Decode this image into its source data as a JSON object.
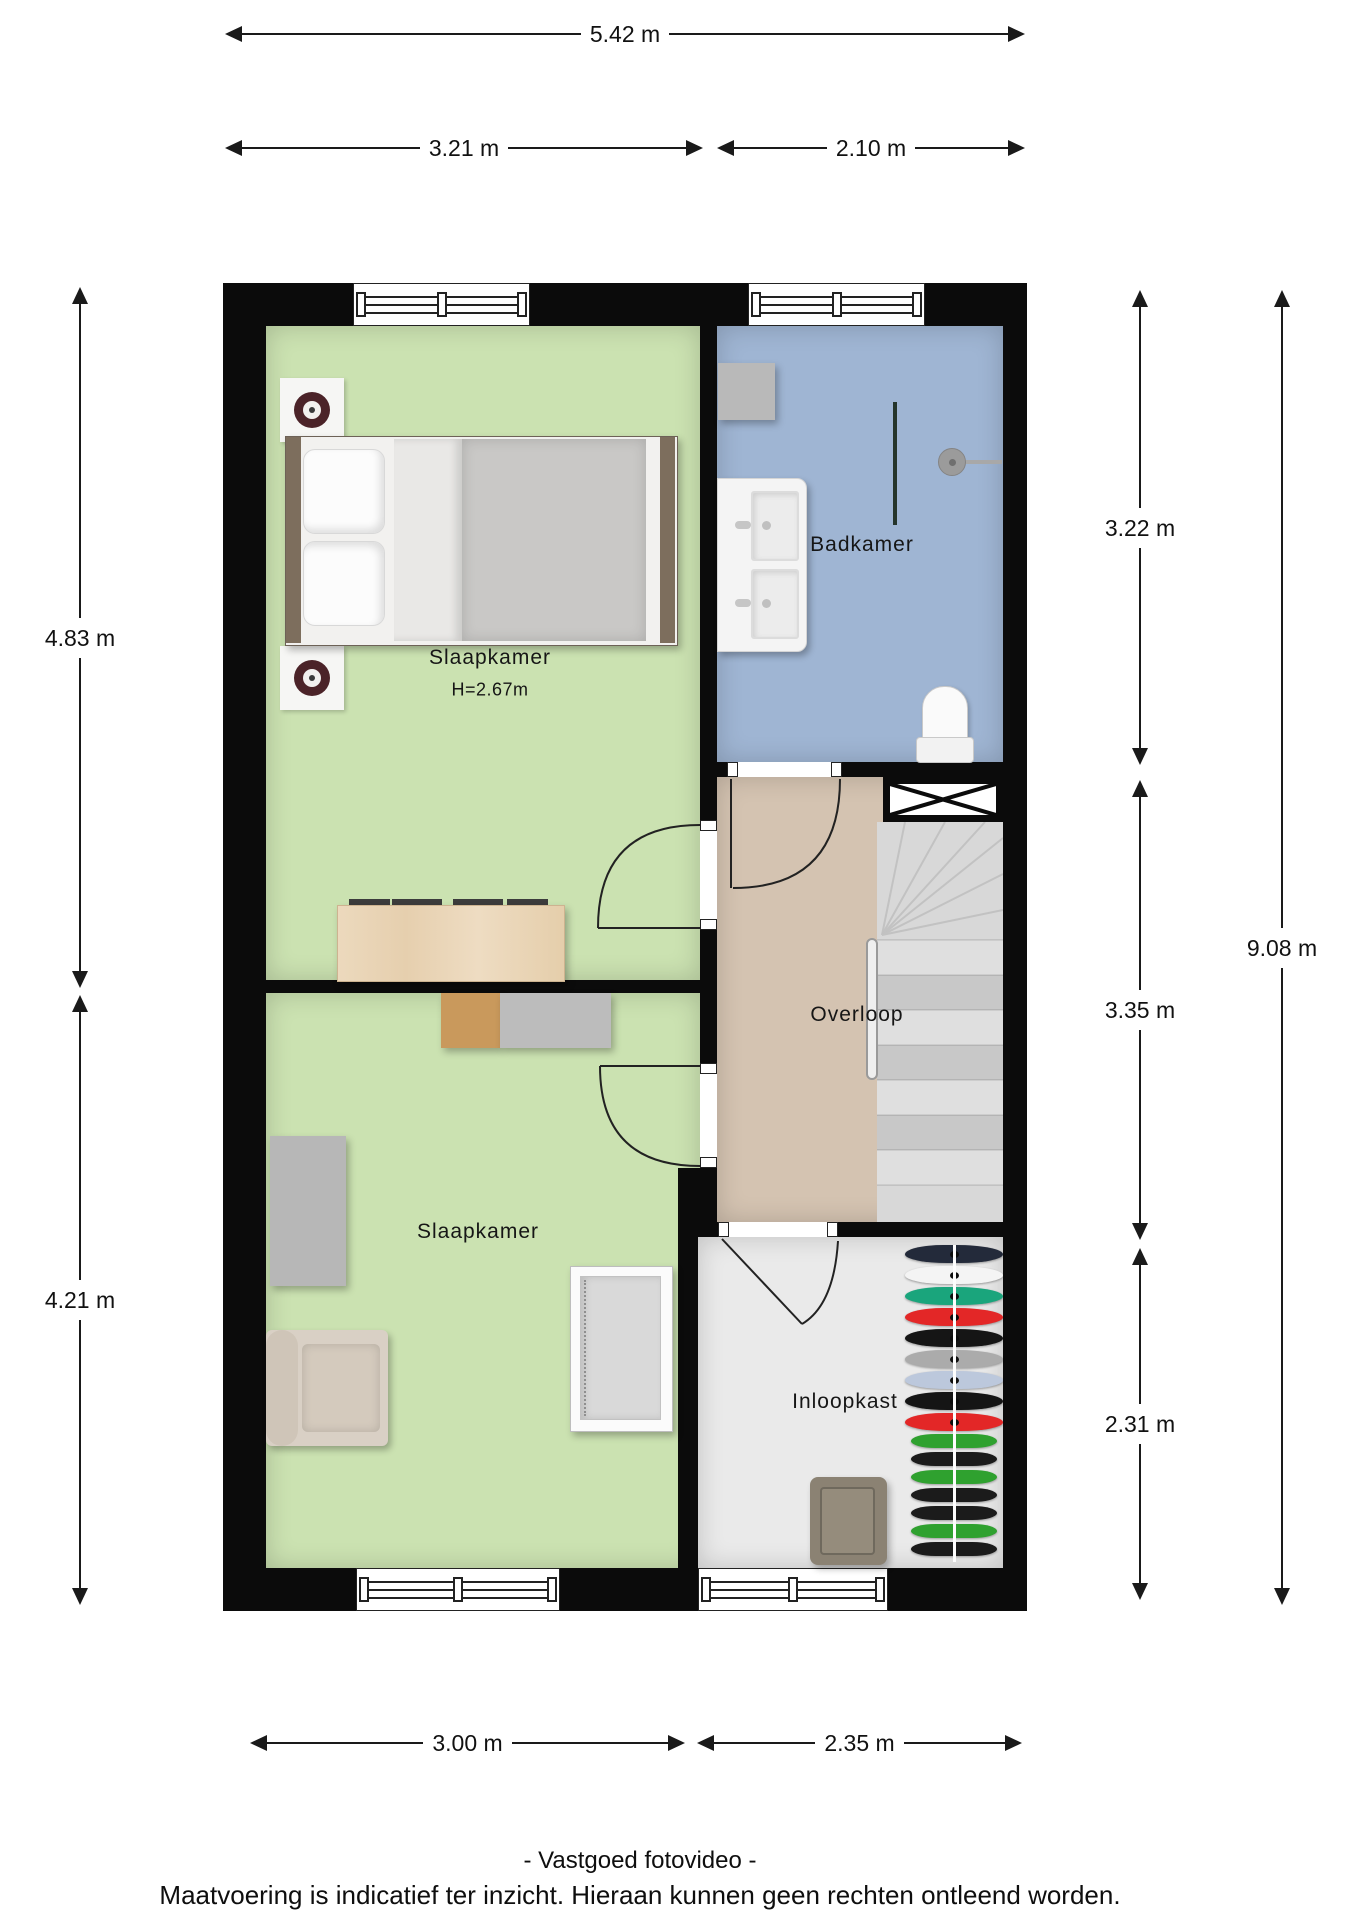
{
  "page": {
    "footer_line1": "- Vastgoed fotovideo -",
    "footer_line2": "Maatvoering is indicatief ter inzicht. Hieraan kunnen geen rechten ontleend worden."
  },
  "rooms": {
    "bedroom_main": {
      "label": "Slaapkamer",
      "ceiling_height": "H=2.67m"
    },
    "bathroom": {
      "label": "Badkamer"
    },
    "landing": {
      "label": "Overloop"
    },
    "bedroom_second": {
      "label": "Slaapkamer"
    },
    "walk_in_closet": {
      "label": "Inloopkast"
    }
  },
  "dimensions": {
    "total_width": "5.42 m",
    "top_left_width": "3.21 m",
    "top_right_width": "2.10 m",
    "left_upper_height": "4.83 m",
    "left_lower_height": "4.21 m",
    "right_bathroom_height": "3.22 m",
    "right_landing_height": "3.35 m",
    "right_closet_height": "2.31 m",
    "total_height": "9.08 m",
    "bottom_left_width": "3.00 m",
    "bottom_right_width": "2.35 m"
  },
  "colors": {
    "wall": "#0b0b0b",
    "bedroom_floor": "#cbe2b1",
    "bathroom_floor": "#9fb5d3",
    "landing_floor": "#d4c3b1",
    "closet_floor": "#eaeaea",
    "stairs": "#d8d8d8"
  },
  "closet": {
    "clothes_colors": [
      "#232a3a",
      "#f4f4f4",
      "#1aa57c",
      "#e32727",
      "#151515",
      "#ababab",
      "#bcc8dc",
      "#151515",
      "#e32727",
      "#2fa12f",
      "#1b1b1b",
      "#2fa12f",
      "#1b1b1b",
      "#1b1b1b",
      "#2fa12f",
      "#1b1b1b"
    ]
  }
}
